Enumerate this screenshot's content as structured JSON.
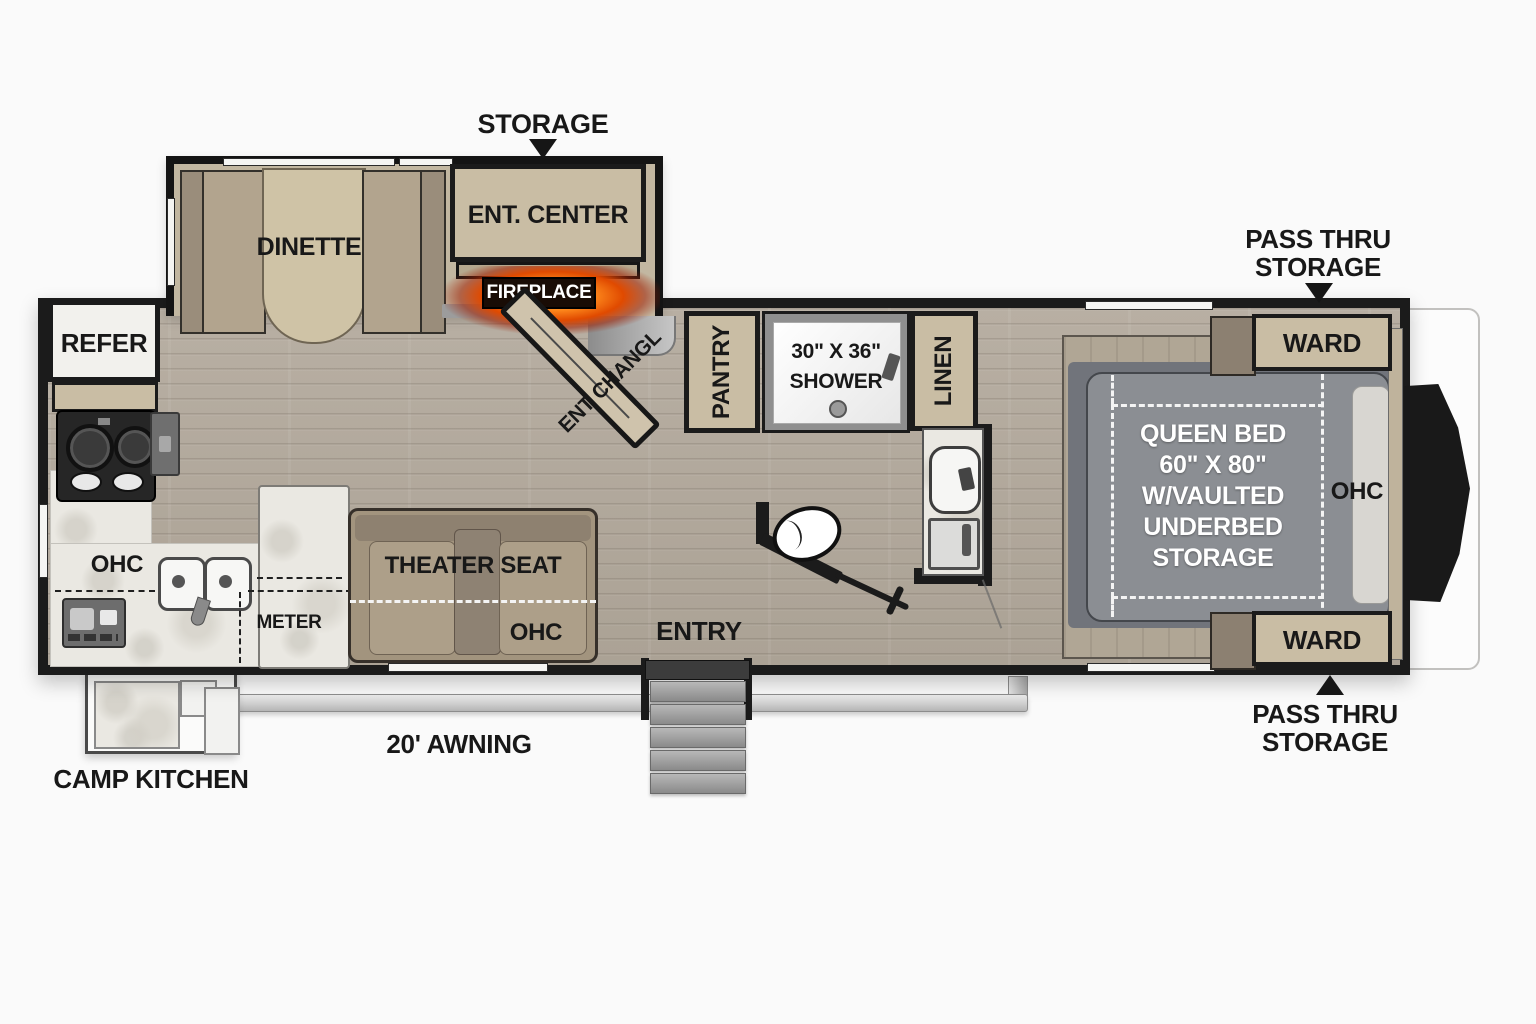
{
  "diagram_type": "rv-travel-trailer-floorplan",
  "labels": {
    "storage": "STORAGE",
    "dinette": "DINETTE",
    "ent_center": "ENT. CENTER",
    "fireplace": "FIREPLACE",
    "ent_door": "ENT CHANGL",
    "refer": "REFER",
    "pantry": "PANTRY",
    "shower_size": "30\" X 36\"",
    "shower": "SHOWER",
    "linen": "LINEN",
    "kitchen_ohc": "OHC",
    "meter": "METER",
    "theater_seat": "THEATER SEAT",
    "theater_ohc": "OHC",
    "entry": "ENTRY",
    "bed_line1": "QUEEN BED",
    "bed_line2": "60\" X 80\"",
    "bed_line3": "W/VAULTED",
    "bed_line4": "UNDERBED",
    "bed_line5": "STORAGE",
    "bed_ohc": "OHC",
    "ward_top": "WARD",
    "ward_bottom": "WARD",
    "pass_thru_top_1": "PASS THRU",
    "pass_thru_top_2": "STORAGE",
    "pass_thru_bottom_1": "PASS THRU",
    "pass_thru_bottom_2": "STORAGE",
    "awning": "20' AWNING",
    "camp_kitchen": "CAMP KITCHEN"
  },
  "colors": {
    "background": "#fafafa",
    "wall": "#1b1b1b",
    "cabinet_tan": "#c9bda4",
    "upholstery_tan": "#a89a84",
    "wood_floor": "#b3aa9e",
    "counter_marble": "#eae8e2",
    "mattress_gray": "#8b8e93",
    "fireplace_glow": "#ff8c1e",
    "bed_text": "#ffffff"
  }
}
